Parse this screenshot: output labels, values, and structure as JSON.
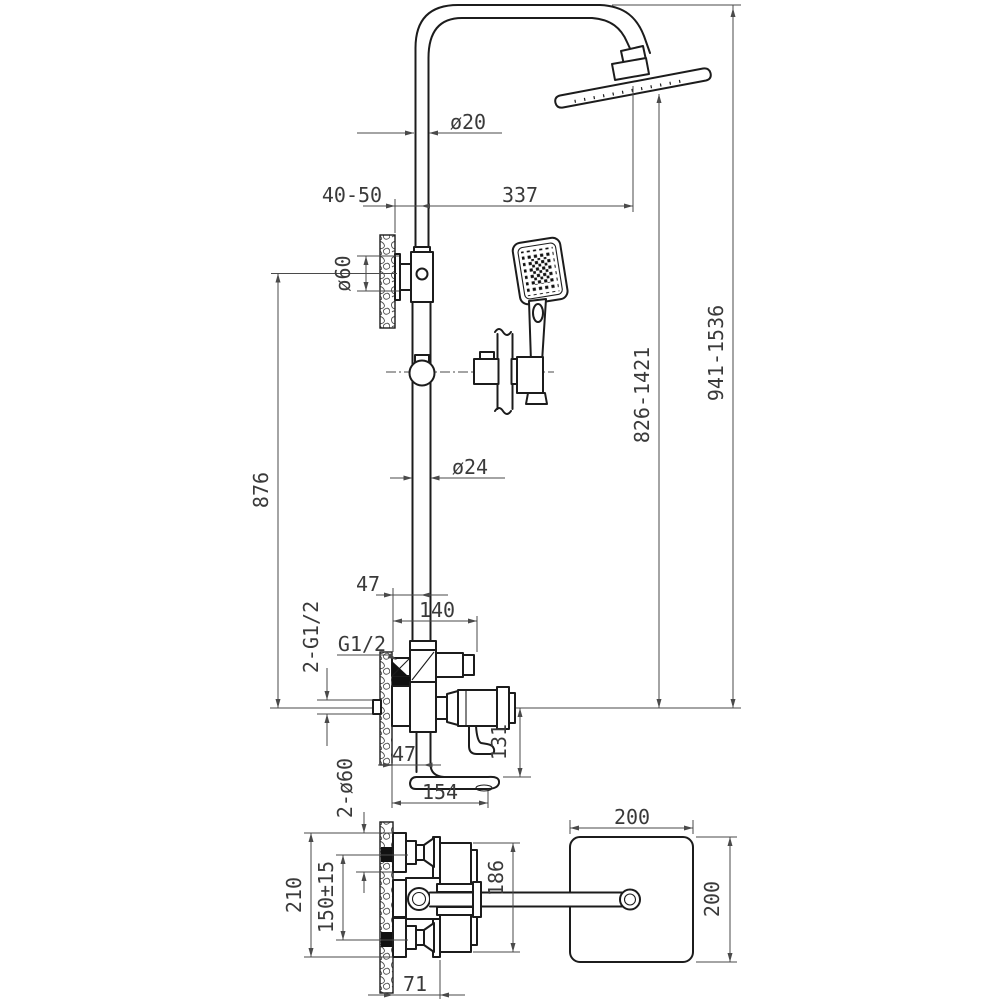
{
  "drawing": {
    "subject": "shower-column-technical-drawing",
    "views": {
      "front": "front elevation",
      "plan": "bottom plan"
    },
    "dims": {
      "riser_upper_diameter": "ø20",
      "wall_offset_range": "40-50",
      "arm_projection": "337",
      "bracket_escutcheon_diameter": "ø60",
      "riser_length": "876",
      "riser_lower_diameter": "ø24",
      "head_height_range": "826-1421",
      "overall_height_range": "941-1536",
      "mixer_wall_offset": "47",
      "mixer_projection": "140",
      "inlet_thread": "G1/2",
      "inlet_threads_count": "2-G1/2",
      "spout_drop_height": "131",
      "spout_wall_offset": "47",
      "spout_projection": "154",
      "escutcheon_count_diameter": "2-ø60",
      "plan_overall_height": "210",
      "inlet_spacing": "150±15",
      "plan_body_depth": "186",
      "head_width": "200",
      "head_depth": "200",
      "plan_wall_to_plate": "71"
    }
  }
}
